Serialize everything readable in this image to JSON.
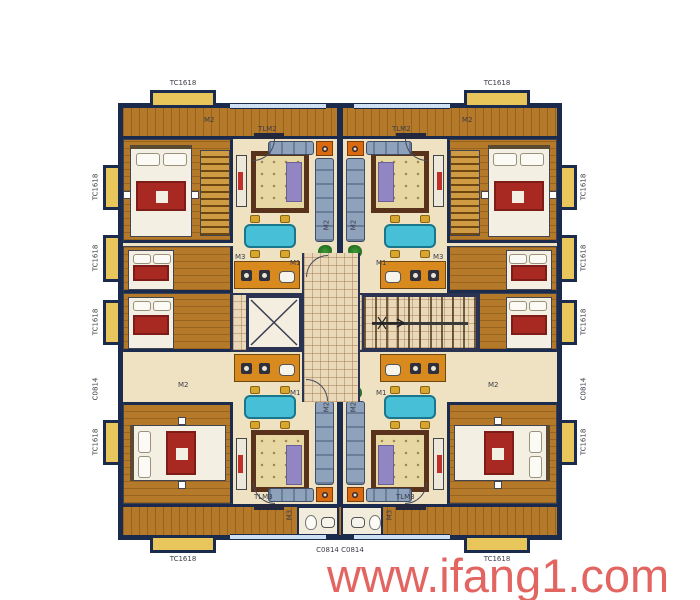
{
  "watermark": {
    "text": "www.ifang1.com",
    "color": "#e15551"
  },
  "codes": {
    "window_bay": "TC1618",
    "window_small": "C0814",
    "window_small_pair": "C0814 C0814",
    "balcony_door_top": "TLM2",
    "balcony_door_bottom": "TLM3",
    "entry_door": "M1",
    "room_door": "M2",
    "small_door": "M3"
  },
  "colors": {
    "wall": "#1b2b4e",
    "wood": "#b5792a",
    "floor": "#efe2c2",
    "tile": "#ead9b8",
    "bay": "#e9c65b",
    "winblue": "#cfe0f2",
    "sofa": "#8fa2bb",
    "rugb": "#58321a",
    "rugf": "#e6d7a3",
    "throw": "#9186c2",
    "teal": "#47bfd6",
    "gold": "#d7a62f",
    "red": "#a82822",
    "orange": "#d96a12"
  }
}
